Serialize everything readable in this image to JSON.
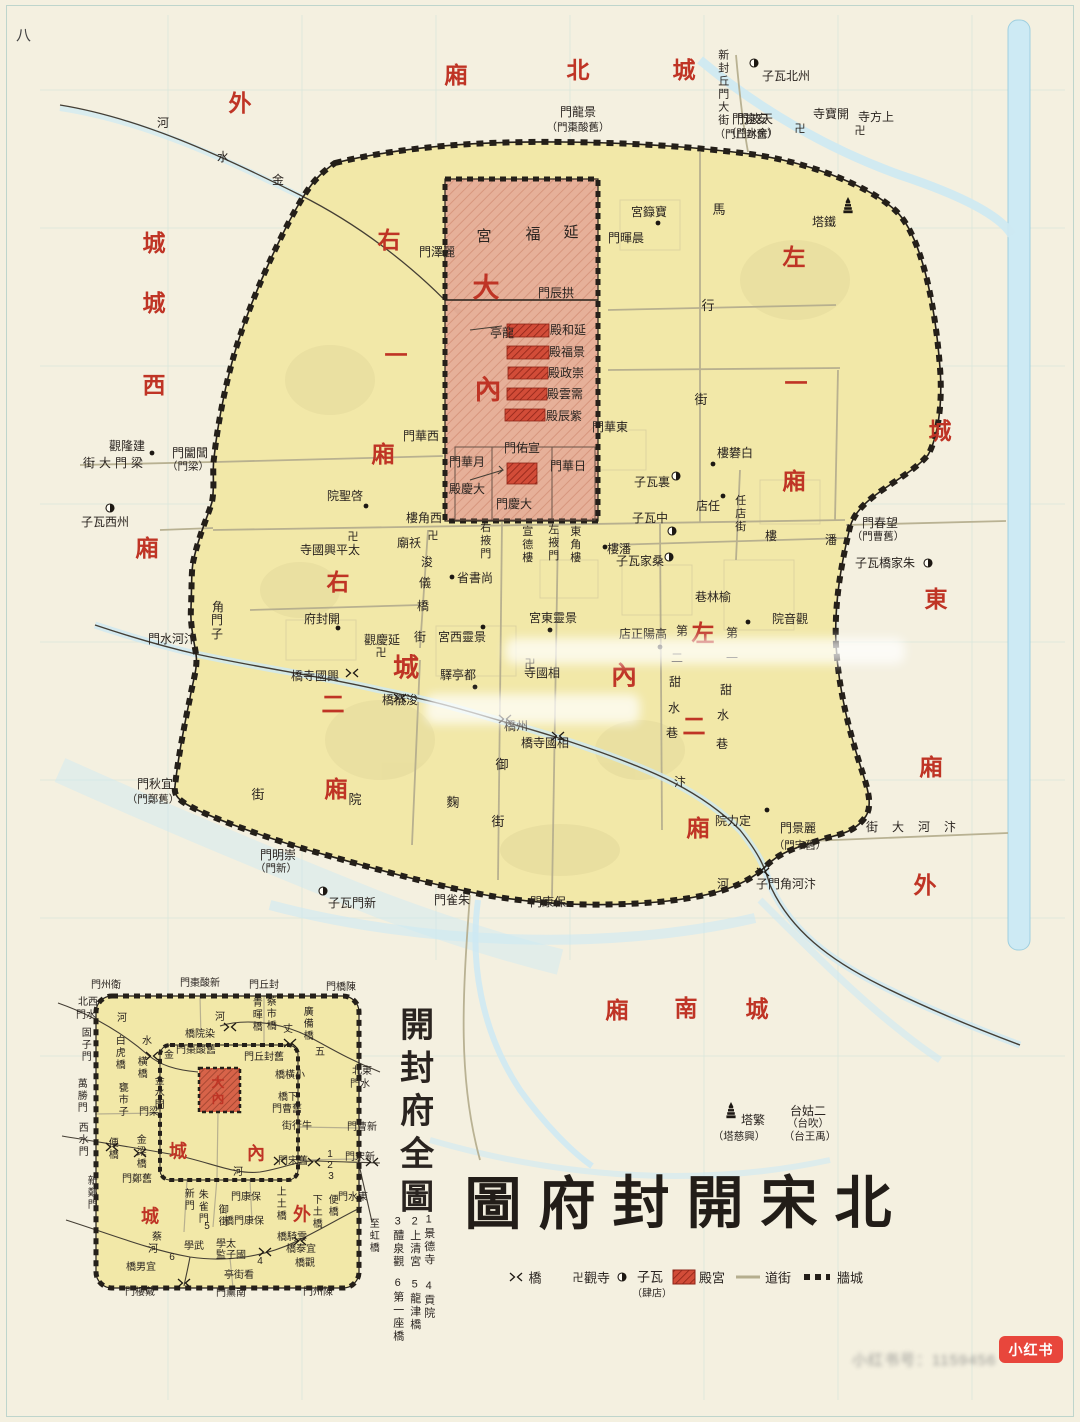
{
  "page": {
    "number": "八",
    "watermark_badge": "小红书",
    "watermark_text": "小红书号：1159456"
  },
  "title": {
    "text_reading": "北宋開封府圖",
    "chars": [
      [
        "圖",
        493,
        1205,
        57
      ],
      [
        "府",
        567,
        1205,
        57
      ],
      [
        "封",
        641,
        1204,
        57
      ],
      [
        "開",
        715,
        1204,
        57
      ],
      [
        "宋",
        789,
        1204,
        57
      ],
      [
        "北",
        863,
        1204,
        57
      ]
    ]
  },
  "legend": {
    "items": [
      {
        "symbol": "bridge-icon",
        "sx": 516,
        "sy": 1277,
        "x": 535,
        "y": 1277,
        "label": "橋"
      },
      {
        "symbol": "swastika-icon",
        "sx": 578,
        "sy": 1277,
        "x": 597,
        "y": 1277,
        "label": "觀寺"
      },
      {
        "symbol": "wazi-icon",
        "sx": 622,
        "sy": 1277,
        "x": 650,
        "y": 1276,
        "label": "子瓦",
        "sub": "（肆店）",
        "sub_x": 652,
        "sub_y": 1292
      },
      {
        "symbol": "palace-swatch",
        "sx": 684,
        "sy": 1277,
        "x": 712,
        "y": 1277,
        "label": "殿宮"
      },
      {
        "symbol": "street-swatch",
        "sx": 748,
        "sy": 1277,
        "x": 778,
        "y": 1277,
        "label": "道街"
      },
      {
        "symbol": "wall-swatch",
        "sx": 817,
        "sy": 1277,
        "x": 850,
        "y": 1277,
        "label": "牆城"
      }
    ]
  },
  "main_map": {
    "red_labels": [
      [
        "廂",
        456,
        76
      ],
      [
        "北",
        578,
        71
      ],
      [
        "城",
        684,
        71
      ],
      [
        "外",
        240,
        104
      ],
      [
        "城",
        154,
        244
      ],
      [
        "城",
        154,
        304
      ],
      [
        "西",
        154,
        386
      ],
      [
        "廂",
        147,
        549
      ],
      [
        "右",
        389,
        241
      ],
      [
        "一",
        396,
        356
      ],
      [
        "廂",
        383,
        455
      ],
      [
        "左",
        794,
        258
      ],
      [
        "一",
        796,
        384
      ],
      [
        "廂",
        794,
        482
      ],
      [
        "大",
        486,
        288,
        27
      ],
      [
        "內",
        488,
        390,
        27
      ],
      [
        "右",
        338,
        583
      ],
      [
        "二",
        333,
        705
      ],
      [
        "廂",
        336,
        790
      ],
      [
        "城",
        406,
        668,
        26
      ],
      [
        "內",
        624,
        676,
        26
      ],
      [
        "左",
        703,
        634
      ],
      [
        "二",
        694,
        727
      ],
      [
        "廂",
        698,
        829
      ],
      [
        "城",
        940,
        432
      ],
      [
        "東",
        936,
        600
      ],
      [
        "廂",
        931,
        768
      ],
      [
        "外",
        925,
        886
      ],
      [
        "廂",
        617,
        1011
      ],
      [
        "南",
        686,
        1009
      ],
      [
        "城",
        757,
        1010
      ]
    ],
    "labels": [
      [
        "門波天",
        755,
        119
      ],
      [
        "（門水金）",
        752,
        134,
        10.5
      ],
      [
        "門龍景",
        578,
        112
      ],
      [
        "（門棗酸舊）",
        578,
        128,
        10.5
      ],
      [
        "門遠安",
        750,
        119
      ],
      [
        "（門丘封舊）",
        746,
        135,
        10.5
      ],
      [
        "子瓦北州",
        786,
        76
      ],
      [
        "寺寶開",
        831,
        114
      ],
      [
        "寺方上",
        876,
        117
      ],
      [
        "塔鐵",
        824,
        222
      ],
      [
        "宮籙寶",
        649,
        212
      ],
      [
        "門暉晨",
        626,
        238
      ],
      [
        "門澤麗",
        437,
        252
      ],
      [
        "新封丘門大街",
        722,
        88,
        11,
        "v"
      ],
      [
        "馬",
        719,
        210,
        13
      ],
      [
        "行",
        708,
        306,
        13
      ],
      [
        "街",
        701,
        400,
        13
      ],
      [
        "河",
        163,
        123
      ],
      [
        "水",
        223,
        157
      ],
      [
        "金",
        278,
        180
      ],
      [
        "宮",
        484,
        237,
        15
      ],
      [
        "福",
        533,
        235,
        15
      ],
      [
        "延",
        571,
        233,
        15
      ],
      [
        "門辰拱",
        556,
        293
      ],
      [
        "亭龍",
        502,
        333
      ],
      [
        "殿和延",
        568,
        330
      ],
      [
        "殿福景",
        567,
        352
      ],
      [
        "殿政崇",
        566,
        373
      ],
      [
        "殿雲需",
        565,
        394
      ],
      [
        "殿辰紫",
        564,
        416
      ],
      [
        "門華西",
        421,
        436
      ],
      [
        "門華東",
        610,
        427
      ],
      [
        "門佑宣",
        522,
        448
      ],
      [
        "門華月",
        467,
        462
      ],
      [
        "門華日",
        568,
        466
      ],
      [
        "殿慶大",
        467,
        489
      ],
      [
        "門慶大",
        514,
        504
      ],
      [
        "樓角西",
        424,
        518
      ],
      [
        "右掖門",
        484,
        541,
        11,
        "v"
      ],
      [
        "宣德樓",
        526,
        545,
        11,
        "v"
      ],
      [
        "左掖門",
        552,
        543,
        11,
        "v"
      ],
      [
        "東角樓",
        574,
        545,
        11,
        "v"
      ],
      [
        "子瓦裏",
        652,
        482
      ],
      [
        "子瓦中",
        650,
        518
      ],
      [
        "樓潘",
        619,
        549
      ],
      [
        "子瓦家桑",
        640,
        561
      ],
      [
        "樓礬白",
        735,
        453
      ],
      [
        "店任",
        708,
        506
      ],
      [
        "任店街",
        739,
        514,
        11,
        "v"
      ],
      [
        "樓",
        771,
        536
      ],
      [
        "潘",
        831,
        540
      ],
      [
        "觀隆建",
        127,
        446
      ],
      [
        "街大門梁",
        115,
        463,
        12,
        "h",
        4
      ],
      [
        "門闔閶",
        190,
        453
      ],
      [
        "（門梁）",
        188,
        467,
        10.5
      ],
      [
        "子瓦西州",
        105,
        522
      ],
      [
        "廟祅",
        409,
        543
      ],
      [
        "院聖啓",
        345,
        496
      ],
      [
        "寺國興平太",
        330,
        550
      ],
      [
        "省書尚",
        475,
        578
      ],
      [
        "浚",
        427,
        562
      ],
      [
        "儀",
        425,
        583
      ],
      [
        "橋",
        423,
        606
      ],
      [
        "街",
        420,
        637
      ],
      [
        "宮東靈景",
        553,
        618
      ],
      [
        "宮西靈景",
        462,
        637
      ],
      [
        "驛亭都",
        458,
        675
      ],
      [
        "寺國相",
        542,
        673
      ],
      [
        "店正陽高",
        643,
        634
      ],
      [
        "第",
        682,
        631
      ],
      [
        "二",
        677,
        658
      ],
      [
        "甜",
        675,
        682
      ],
      [
        "水",
        674,
        708
      ],
      [
        "巷",
        672,
        733
      ],
      [
        "第",
        732,
        633
      ],
      [
        "一",
        732,
        658
      ],
      [
        "甜",
        726,
        690
      ],
      [
        "水",
        723,
        715
      ],
      [
        "巷",
        722,
        744
      ],
      [
        "巷林榆",
        713,
        597
      ],
      [
        "院音觀",
        790,
        619
      ],
      [
        "子瓦橋家朱",
        885,
        563
      ],
      [
        "門春望",
        880,
        523
      ],
      [
        "（門曹舊）",
        878,
        537,
        10.5
      ],
      [
        "府封開",
        322,
        619
      ],
      [
        "觀慶延",
        382,
        640
      ],
      [
        "角",
        218,
        607
      ],
      [
        "門",
        217,
        620
      ],
      [
        "子",
        217,
        634
      ],
      [
        "門水河汴",
        172,
        639
      ],
      [
        "橋寺國興",
        315,
        676
      ],
      [
        "橋儀浚",
        400,
        700
      ],
      [
        "橋州",
        516,
        726
      ],
      [
        "橋寺國相",
        545,
        743
      ],
      [
        "御",
        502,
        765,
        13
      ],
      [
        "街",
        498,
        822,
        13
      ],
      [
        "街",
        258,
        795,
        13
      ],
      [
        "院",
        355,
        800,
        13
      ],
      [
        "麴",
        453,
        803,
        13
      ],
      [
        "門秋宜",
        155,
        784
      ],
      [
        "（門鄭舊）",
        153,
        800,
        10.5
      ],
      [
        "門明崇",
        278,
        855
      ],
      [
        "（門新）",
        276,
        869,
        10.5
      ],
      [
        "子瓦門新",
        352,
        903
      ],
      [
        "門雀朱",
        452,
        900
      ],
      [
        "門康保",
        548,
        902
      ],
      [
        "汴",
        680,
        782
      ],
      [
        "河",
        723,
        884
      ],
      [
        "院力定",
        733,
        821
      ],
      [
        "門景麗",
        798,
        828
      ],
      [
        "（門宋舊）",
        800,
        846,
        10.5
      ],
      [
        "街大河汴",
        918,
        827,
        12,
        "h",
        14
      ],
      [
        "子門角河汴",
        786,
        884
      ],
      [
        "塔繁",
        753,
        1120
      ],
      [
        "（塔慈興）",
        739,
        1137,
        10.5
      ],
      [
        "台姑二",
        808,
        1111
      ],
      [
        "（台吹）",
        808,
        1124,
        10.5
      ],
      [
        "（台王禹）",
        810,
        1137,
        10.5
      ]
    ]
  },
  "inset": {
    "title": "開封府全圖",
    "key": [
      [
        "1景德寺",
        428,
        1240
      ],
      [
        "2上清宮",
        414,
        1242
      ],
      [
        "3醴泉觀",
        397,
        1242
      ],
      [
        "4貢院",
        428,
        1300
      ],
      [
        "5龍津橋",
        414,
        1305
      ],
      [
        "6第一座橋",
        397,
        1310
      ]
    ],
    "red_labels": [
      [
        "大",
        218,
        1083,
        13
      ],
      [
        "內",
        218,
        1099,
        13
      ],
      [
        "城",
        178,
        1152,
        18
      ],
      [
        "內",
        256,
        1154,
        18
      ],
      [
        "城",
        150,
        1217,
        18
      ],
      [
        "外",
        302,
        1215,
        18
      ]
    ],
    "labels": [
      [
        "門州衛",
        106,
        986
      ],
      [
        "門棗酸新",
        200,
        984
      ],
      [
        "門丘封",
        264,
        986
      ],
      [
        "門橋陳",
        341,
        988
      ],
      [
        "北西",
        88,
        1003
      ],
      [
        "門水",
        86,
        1016
      ],
      [
        "固子門",
        84,
        1045,
        10,
        "v"
      ],
      [
        "河",
        122,
        1019
      ],
      [
        "白虎橋",
        118,
        1053,
        10,
        "v"
      ],
      [
        "水",
        147,
        1042
      ],
      [
        "金",
        169,
        1056
      ],
      [
        "橫橋",
        140,
        1068,
        10,
        "v"
      ],
      [
        "橋院染",
        200,
        1035
      ],
      [
        "門棗酸舊",
        196,
        1051
      ],
      [
        "青暉橋",
        255,
        1015,
        10,
        "v"
      ],
      [
        "蔡市橋",
        269,
        1014,
        10,
        "v"
      ],
      [
        "廣備橋",
        306,
        1024,
        10,
        "v"
      ],
      [
        "河",
        220,
        1018
      ],
      [
        "丈",
        288,
        1030
      ],
      [
        "五",
        320,
        1053
      ],
      [
        "門丘封舊",
        264,
        1058
      ],
      [
        "橋橫小",
        290,
        1076
      ],
      [
        "北東",
        362,
        1072
      ],
      [
        "門水",
        360,
        1085
      ],
      [
        "橋下",
        288,
        1098
      ],
      [
        "門曹舊",
        287,
        1110
      ],
      [
        "街行牛",
        297,
        1127
      ],
      [
        "門曹新",
        362,
        1128
      ],
      [
        "金水門",
        157,
        1093,
        10,
        "v"
      ],
      [
        "門梁",
        149,
        1113
      ],
      [
        "甕市子",
        121,
        1100,
        10,
        "v"
      ],
      [
        "萬勝門",
        80,
        1096,
        10,
        "v"
      ],
      [
        "西水門",
        81,
        1140,
        10,
        "v"
      ],
      [
        "便橋",
        111,
        1149,
        10,
        "v"
      ],
      [
        "金梁橋",
        139,
        1152,
        10,
        "v"
      ],
      [
        "新鄭門",
        90,
        1193,
        10,
        "v"
      ],
      [
        "門鄭舊",
        137,
        1180
      ],
      [
        "新門",
        187,
        1200,
        10,
        "v"
      ],
      [
        "朱雀門",
        201,
        1207,
        10,
        "v"
      ],
      [
        "御街",
        221,
        1216,
        10,
        "v"
      ],
      [
        "門康保",
        246,
        1198
      ],
      [
        "橋門康保",
        244,
        1222
      ],
      [
        "上土橋",
        279,
        1204,
        10,
        "v"
      ],
      [
        "下土橋",
        315,
        1212,
        10,
        "v"
      ],
      [
        "便橋",
        331,
        1206,
        10,
        "v"
      ],
      [
        "門水東",
        353,
        1198
      ],
      [
        "至虹橋",
        372,
        1236,
        10,
        "v"
      ],
      [
        "門宋舊",
        293,
        1162
      ],
      [
        "門宋新",
        360,
        1158
      ],
      [
        "河",
        238,
        1173
      ],
      [
        "1",
        330,
        1155
      ],
      [
        "2",
        330,
        1166
      ],
      [
        "3",
        331,
        1177
      ],
      [
        "5",
        207,
        1227
      ],
      [
        "6",
        172,
        1258
      ],
      [
        "4",
        260,
        1262
      ],
      [
        "學武",
        194,
        1247
      ],
      [
        "學太",
        226,
        1245
      ],
      [
        "監子國",
        231,
        1256
      ],
      [
        "亭街看",
        239,
        1276
      ],
      [
        "蔡",
        157,
        1238
      ],
      [
        "河",
        153,
        1250
      ],
      [
        "橋男宜",
        141,
        1268
      ],
      [
        "門樓戴",
        140,
        1293
      ],
      [
        "門薰南",
        231,
        1294
      ],
      [
        "門州陳",
        318,
        1293
      ],
      [
        "橋騎雲",
        292,
        1238
      ],
      [
        "橋泰宜",
        301,
        1250
      ],
      [
        "橋觀",
        305,
        1264
      ]
    ]
  },
  "markers": {
    "dots": [
      [
        152,
        453
      ],
      [
        366,
        506
      ],
      [
        452,
        577
      ],
      [
        338,
        628
      ],
      [
        475,
        687
      ],
      [
        483,
        627
      ],
      [
        550,
        630
      ],
      [
        660,
        647
      ],
      [
        605,
        547
      ],
      [
        713,
        464
      ],
      [
        723,
        496
      ],
      [
        767,
        810
      ],
      [
        658,
        223
      ],
      [
        748,
        622
      ]
    ],
    "wazi": [
      [
        754,
        63
      ],
      [
        110,
        508
      ],
      [
        676,
        476
      ],
      [
        672,
        531
      ],
      [
        669,
        557
      ],
      [
        928,
        563
      ],
      [
        323,
        891
      ]
    ],
    "temples": [
      [
        800,
        128
      ],
      [
        860,
        130
      ],
      [
        353,
        536
      ],
      [
        433,
        535
      ],
      [
        381,
        652
      ],
      [
        530,
        663
      ]
    ],
    "pagodas": [
      [
        848,
        210
      ],
      [
        731,
        1115
      ]
    ],
    "bridges": [
      [
        352,
        673
      ],
      [
        400,
        698
      ],
      [
        505,
        719
      ],
      [
        558,
        736
      ],
      [
        763,
        872
      ],
      [
        230,
        1027
      ],
      [
        290,
        1043
      ],
      [
        152,
        1056
      ],
      [
        112,
        1147
      ],
      [
        140,
        1153
      ],
      [
        265,
        1252
      ],
      [
        300,
        1241
      ],
      [
        280,
        1161
      ],
      [
        314,
        1162
      ],
      [
        372,
        1162
      ],
      [
        184,
        1283
      ]
    ]
  },
  "colors": {
    "district_red": "#bf3425",
    "palace_fill": "#e6ae98",
    "hall_red": "#cf4232",
    "city_yellow": "#f2e8a8",
    "river_blue": "#cde9f3",
    "wall_black": "#241f19",
    "street": "#b5ae8e",
    "badge_red": "#e8463c"
  }
}
